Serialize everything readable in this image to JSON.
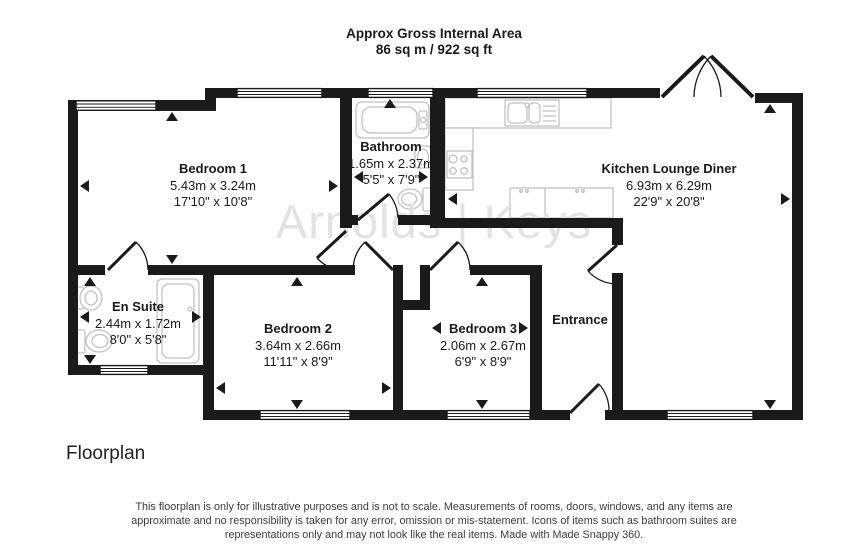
{
  "header": {
    "title": "Approx Gross Internal Area",
    "area": "86 sq m / 922 sq ft"
  },
  "watermark": "Arnolds | Keys",
  "rooms": {
    "bedroom1": {
      "name": "Bedroom 1",
      "metric": "5.43m x 3.24m",
      "imperial": "17'10\" x 10'8\""
    },
    "bathroom": {
      "name": "Bathroom",
      "metric": "1.65m x 2.37m",
      "imperial": "5'5\" x 7'9\""
    },
    "kitchen": {
      "name": "Kitchen Lounge Diner",
      "metric": "6.93m x 6.29m",
      "imperial": "22'9\" x 20'8\""
    },
    "ensuite": {
      "name": "En Suite",
      "metric": "2.44m x 1.72m",
      "imperial": "8'0\" x 5'8\""
    },
    "bedroom2": {
      "name": "Bedroom 2",
      "metric": "3.64m x 2.66m",
      "imperial": "11'11\" x 8'9\""
    },
    "bedroom3": {
      "name": "Bedroom 3",
      "metric": "2.06m x 2.67m",
      "imperial": "6'9\" x 8'9\""
    },
    "entrance": {
      "name": "Entrance"
    }
  },
  "footer": {
    "caption": "Floorplan",
    "disclaimer": "This floorplan is only for illustrative purposes and is not to scale. Measurements of rooms, doors, windows, and any items are approximate and no responsibility is taken for any error, omission or mis-statement. Icons of items such as bathroom suites are representations only and may not look like the real items. Made with Made Snappy 360."
  },
  "colors": {
    "wall": "#1a1a1a",
    "fixture": "#c2c2c2",
    "watermark": "#e3e3e3"
  }
}
